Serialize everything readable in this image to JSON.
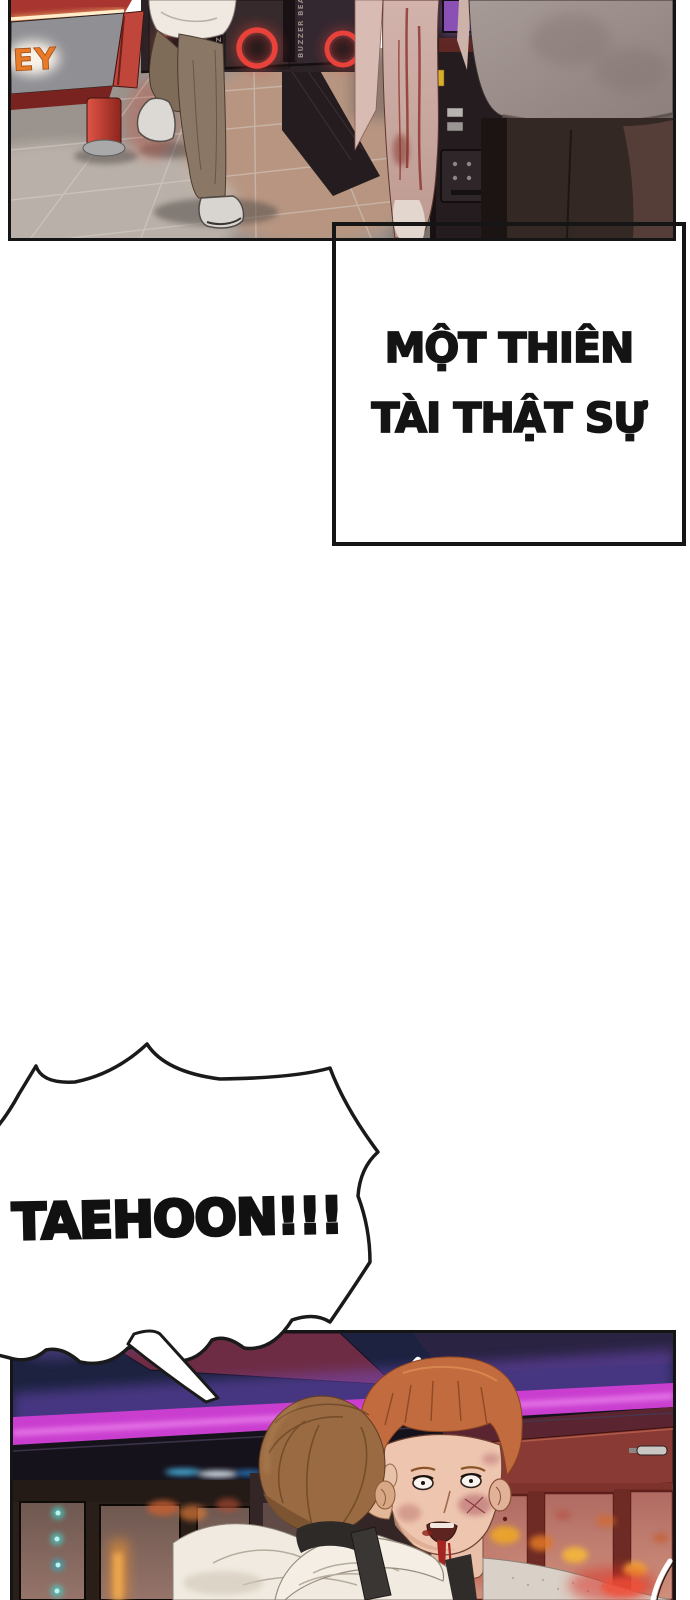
{
  "page": {
    "kind": "webtoon comic page"
  },
  "speech_box": {
    "line1": "MỘT THIÊN",
    "line2": "TÀI THẬT SỰ"
  },
  "shout_bubble": {
    "text": "TAEHOON!!!"
  },
  "arcade": {
    "cabinet_label": "BUZZER BEATER",
    "hockey_sign": "EY"
  },
  "colors": {
    "panel_border": "#151515",
    "neon_magenta": "#c93ecf",
    "ring_red": "#e8423a",
    "sign_orange": "#e87b28",
    "ink": "#141414"
  }
}
